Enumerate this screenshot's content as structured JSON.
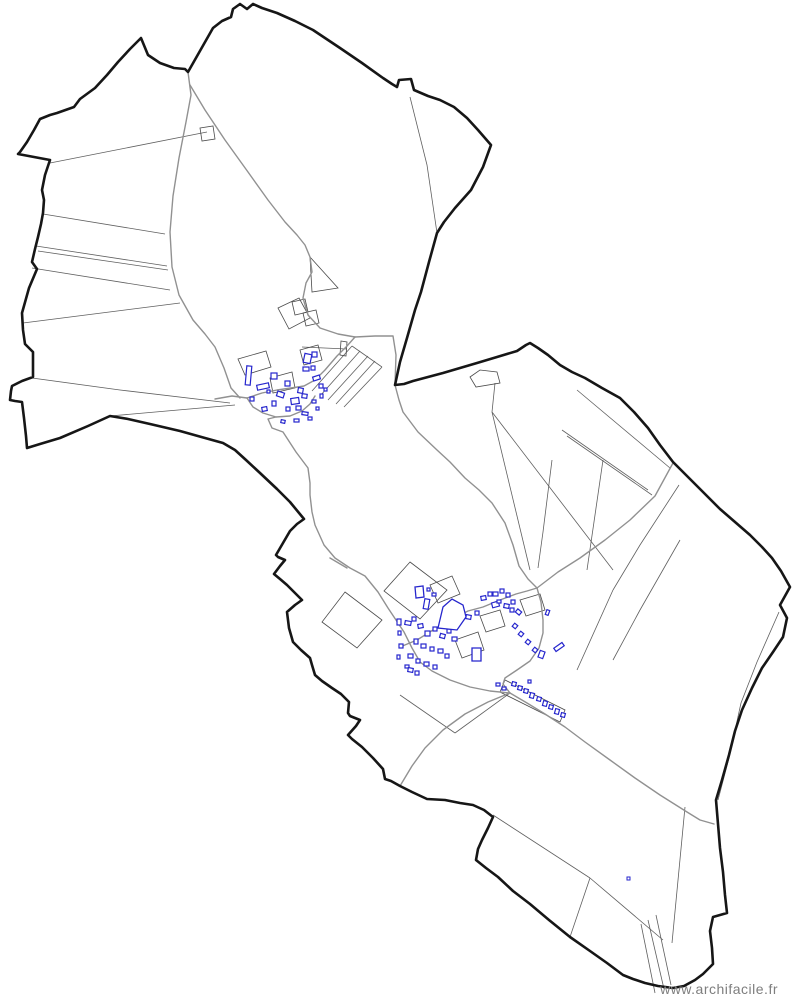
{
  "watermark": {
    "text": "www.archifacile.fr"
  },
  "colors": {
    "background": "#ffffff",
    "boundary": "#161616",
    "parcel": "#5f5f5f",
    "parcel_poly": "#4a4a4a",
    "road": "#919191",
    "building": "#2626cd",
    "watermark": "#7e7e7e"
  },
  "map": {
    "width": 794,
    "height": 1004,
    "boundary": "141,38 148,55 160,63 174,68 185,69 188,72 213,28 222,21 231,17 233,9 240,4 247,9 253,4 262,8 277,13 295,21 313,30 340,48 362,63 383,78 392,84 397,87 399,80 411,79 414,90 428,96 440,100 454,107 467,118 478,130 491,145 483,167 471,190 455,208 444,222 437,233 429,262 421,292 415,310 407,338 400,362 395,385 404,384 413,381 428,377 443,373 460,368 477,363 497,357 517,351 526,345 530,343 538,348 548,355 560,365 572,372 585,378 602,388 620,398 634,412 648,428 660,445 673,462 690,479 705,494 720,509 735,522 750,535 762,547 772,558 781,571 790,587 780,605 787,618 783,637 773,652 762,668 752,688 742,710 735,731 729,755 722,780 716,800 718,824 720,848 723,872 725,895 727,913 713,917 710,931 712,948 713,964 703,974 695,980 684,986 673,988 658,986 645,983 633,979 623,975 607,963 590,951 570,937 549,920 530,904 513,891 498,877 486,868 476,860 478,849 482,840 488,828 493,817 484,810 473,805 460,803 445,800 427,799 412,792 400,786 391,781 385,779 383,769 373,758 362,747 352,739 348,735 356,726 360,720 350,716 348,713 349,702 341,694 332,688 322,681 315,675 312,665 310,658 301,650 293,642 289,628 287,612 295,605 302,600 294,592 287,585 280,579 274,574 280,566 285,560 278,557 276,555 283,543 290,531 297,524 304,519 290,502 277,489 260,473 246,460 235,450 223,443 205,438 180,431 150,424 128,419 110,416 88,426 60,438 40,444 27,448 26,436 24,418 22,402 15,401 10,400 11,391 12,386 22,381 33,377 33,364 33,352 28,347 25,344 23,330 22,313 29,288 37,269 32,262 35,249 38,237 41,224 43,213 44,200 42,190 45,175 48,166 50,160 34,157 18,154 20,152 27,142 34,130 40,119 50,115 57,113 74,107 80,99 95,88 107,75 118,62 130,49",
    "roads": [
      "188,72 191,95 186,122 179,158 173,196 170,232 172,267 179,295 193,320 205,334 215,347 224,368 231,388 240,398",
      "190,85 205,110 225,140 248,172 268,200 285,222 297,235 305,245 310,257 312,272 306,283 303,298 308,315 320,328 338,334 355,337",
      "355,337 375,336 393,336 396,355 395,385",
      "215,399 232,396 247,398 262,393 277,390 291,388 304,386 315,380 325,370 337,356 347,346 355,337",
      "247,398 253,407 263,413 276,417 290,416 302,411 310,404 315,396",
      "276,417 268,419 272,428 283,432 296,452 308,468 310,483 310,495 312,512 315,525 324,545 335,558 350,568 365,576 378,592 388,608 396,620 404,632 412,648 420,662 432,671 450,680 470,687 490,691 510,693",
      "395,385 399,400 403,412 418,432 437,450 450,462 465,478 479,490 492,503 505,523 513,545 519,566 528,579 537,588",
      "537,588 558,572 580,558 605,540 630,520 655,496 673,463",
      "400,647 417,640 433,630 450,620 468,611 483,607 500,600 516,594 527,591 537,588",
      "537,588 541,602 543,620 543,633 539,648 530,661 517,670 505,678 503,684 510,693",
      "510,693 527,703 545,714 565,727 585,742 610,760 635,778 660,795 687,812 700,820 714,824",
      "510,693 488,702 465,714 443,730 425,748 412,766 400,786",
      "330,558 347,568"
    ],
    "parcel_lines": [
      "43,214 165,234",
      "36,246 167,266",
      "38,251 168,270",
      "32,268 170,290",
      "23,323 180,303",
      "32,378 120,390 230,403",
      "50,163 207,132",
      "110,416 235,405",
      "410,97 427,165 437,233",
      "577,390 670,468",
      "562,430 648,490",
      "567,436 652,495",
      "492,412 613,570",
      "492,412 530,570",
      "495,383 492,412",
      "552,460 543,532 538,568",
      "603,460 587,570",
      "679,485 640,545 613,590",
      "613,590 577,670",
      "680,540 640,610 613,660",
      "779,612 757,662 741,703 729,758 718,800",
      "493,815 590,878",
      "590,878 663,940",
      "685,807 672,943",
      "590,878 570,937",
      "641,924 655,993",
      "648,920 664,989",
      "656,915 671,985",
      "400,695 455,733",
      "455,733 510,693",
      "312,391 352,346",
      "320,396 360,351",
      "328,400 368,356",
      "336,404 375,361",
      "344,407 382,367",
      "352,346 382,367",
      "302,347 347,349"
    ],
    "parcel_polys": [
      "200,128 213,126 215,139 202,141",
      "470,377 480,370 497,372 500,383 476,387",
      "410,562 447,590 420,619 384,591",
      "345,592 382,620 357,648 322,622",
      "310,257 338,288 312,292",
      "292,302 305,299 308,312 295,315",
      "303,313 316,310 319,323 306,326",
      "278,308 299,298 310,318 289,329",
      "341,341 347,342 346,356 340,355",
      "238,359 266,351 271,367 245,375",
      "270,378 292,372 295,388 273,393",
      "300,350 318,345 322,360 304,365",
      "430,585 452,576 460,594 438,603",
      "455,640 478,632 484,650 462,658",
      "480,616 500,610 505,626 486,632",
      "520,600 540,594 545,610 526,616",
      "505,680 565,710 560,722 500,692"
    ],
    "buildings": [
      [
        246,
        366,
        5,
        19,
        5
      ],
      [
        257,
        384,
        12,
        5,
        -12
      ],
      [
        271,
        373,
        6,
        6,
        0
      ],
      [
        277,
        392,
        7,
        5,
        18
      ],
      [
        285,
        381,
        5,
        5,
        0
      ],
      [
        291,
        398,
        8,
        6,
        -8
      ],
      [
        298,
        388,
        5,
        5,
        10
      ],
      [
        304,
        354,
        7,
        9,
        12
      ],
      [
        312,
        352,
        5,
        5,
        0
      ],
      [
        303,
        367,
        6,
        4,
        0
      ],
      [
        311,
        366,
        4,
        4,
        0
      ],
      [
        313,
        376,
        7,
        4,
        -18
      ],
      [
        319,
        384,
        4,
        4,
        0
      ],
      [
        302,
        394,
        5,
        4,
        8
      ],
      [
        296,
        406,
        5,
        4,
        0
      ],
      [
        286,
        407,
        4,
        4,
        0
      ],
      [
        272,
        401,
        4,
        5,
        0
      ],
      [
        262,
        407,
        5,
        4,
        -10
      ],
      [
        250,
        397,
        4,
        4,
        0
      ],
      [
        302,
        412,
        6,
        3,
        8
      ],
      [
        312,
        400,
        4,
        3,
        0
      ],
      [
        320,
        394,
        3,
        4,
        0
      ],
      [
        308,
        417,
        4,
        3,
        0
      ],
      [
        294,
        419,
        5,
        3,
        0
      ],
      [
        281,
        420,
        4,
        3,
        12
      ],
      [
        316,
        407,
        3,
        3,
        0
      ],
      [
        324,
        388,
        3,
        3,
        0
      ],
      [
        267,
        390,
        3,
        3,
        0
      ],
      [
        424,
        599,
        5,
        10,
        10
      ],
      [
        432,
        593,
        4,
        3,
        0
      ],
      [
        427,
        588,
        3,
        3,
        0
      ],
      [
        458,
        611,
        6,
        5,
        0
      ],
      [
        466,
        615,
        5,
        4,
        10
      ],
      [
        475,
        611,
        4,
        4,
        0
      ],
      [
        481,
        596,
        5,
        4,
        -10
      ],
      [
        488,
        592,
        4,
        4,
        0
      ],
      [
        492,
        602,
        7,
        5,
        -15
      ],
      [
        493,
        592,
        5,
        4,
        0
      ],
      [
        500,
        589,
        4,
        4,
        0
      ],
      [
        506,
        593,
        4,
        4,
        0
      ],
      [
        497,
        600,
        4,
        3,
        0
      ],
      [
        504,
        604,
        5,
        4,
        10
      ],
      [
        511,
        600,
        4,
        4,
        0
      ],
      [
        510,
        608,
        4,
        4,
        0
      ],
      [
        516,
        610,
        5,
        4,
        40
      ],
      [
        513,
        624,
        4,
        4,
        40
      ],
      [
        519,
        632,
        4,
        4,
        40
      ],
      [
        526,
        640,
        4,
        4,
        40
      ],
      [
        533,
        648,
        4,
        4,
        40
      ],
      [
        539,
        651,
        5,
        7,
        20
      ],
      [
        554,
        645,
        10,
        4,
        -35
      ],
      [
        405,
        621,
        6,
        4,
        10
      ],
      [
        412,
        617,
        4,
        4,
        0
      ],
      [
        418,
        624,
        5,
        4,
        -10
      ],
      [
        425,
        631,
        5,
        5,
        0
      ],
      [
        433,
        627,
        4,
        4,
        0
      ],
      [
        440,
        634,
        5,
        4,
        15
      ],
      [
        447,
        629,
        4,
        4,
        0
      ],
      [
        452,
        637,
        5,
        4,
        0
      ],
      [
        414,
        639,
        4,
        5,
        0
      ],
      [
        421,
        644,
        5,
        4,
        0
      ],
      [
        430,
        647,
        4,
        4,
        0
      ],
      [
        438,
        649,
        5,
        4,
        0
      ],
      [
        445,
        654,
        4,
        4,
        0
      ],
      [
        408,
        654,
        5,
        4,
        0
      ],
      [
        416,
        659,
        4,
        4,
        0
      ],
      [
        424,
        662,
        5,
        4,
        0
      ],
      [
        433,
        665,
        4,
        4,
        0
      ],
      [
        405,
        665,
        4,
        3,
        0
      ],
      [
        397,
        619,
        4,
        6,
        0
      ],
      [
        398,
        631,
        3,
        4,
        0
      ],
      [
        399,
        644,
        4,
        4,
        0
      ],
      [
        397,
        655,
        3,
        4,
        0
      ],
      [
        408,
        668,
        5,
        4,
        10
      ],
      [
        415,
        671,
        4,
        4,
        0
      ],
      [
        496,
        683,
        4,
        3,
        0
      ],
      [
        502,
        687,
        4,
        3,
        0
      ],
      [
        512,
        682,
        4,
        4,
        15
      ],
      [
        518,
        686,
        4,
        4,
        15
      ],
      [
        524,
        689,
        4,
        4,
        15
      ],
      [
        530,
        693,
        4,
        5,
        15
      ],
      [
        537,
        697,
        4,
        4,
        15
      ],
      [
        543,
        701,
        4,
        5,
        15
      ],
      [
        549,
        705,
        4,
        4,
        15
      ],
      [
        555,
        709,
        4,
        5,
        15
      ],
      [
        561,
        713,
        4,
        4,
        15
      ],
      [
        528,
        680,
        3,
        3,
        0
      ],
      [
        546,
        610,
        3,
        5,
        20
      ]
    ],
    "building_outlines": [
      "438,628 443,607 452,599 463,605 466,617 457,630",
      "415,587 423,586 424,597 416,598",
      "472,648 481,648 481,661 472,661"
    ],
    "dots": [
      [
        627,
        877
      ]
    ]
  }
}
